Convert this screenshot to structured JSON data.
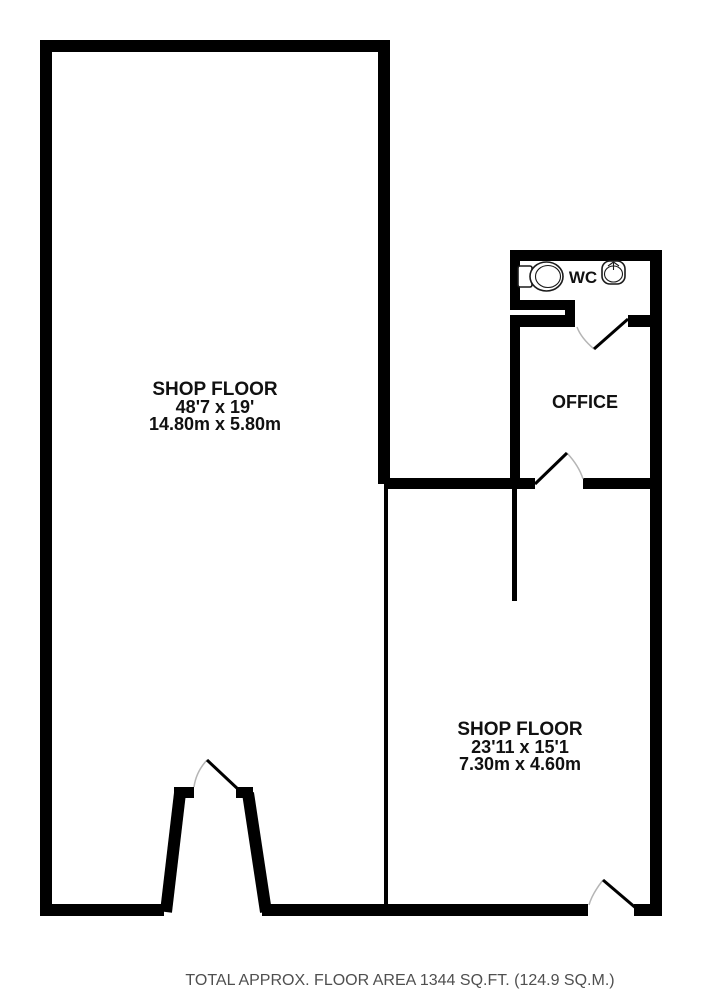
{
  "colors": {
    "wall": "#000000",
    "door_leaf": "#000000",
    "door_arc": "#b5b5b5",
    "fixture_outline": "#1a1a1a",
    "label": "#111111",
    "footer": "#4f4f4f",
    "background": "#ffffff"
  },
  "rooms": {
    "shop_floor_main": {
      "name": "SHOP FLOOR",
      "size_imperial": "48'7 x 19'",
      "size_metric": "14.80m x 5.80m"
    },
    "shop_floor_rear": {
      "name": "SHOP FLOOR",
      "size_imperial": "23'11 x 15'1",
      "size_metric": "7.30m x 4.60m"
    },
    "office": {
      "name": "OFFICE"
    },
    "wc": {
      "name": "WC"
    }
  },
  "fixtures": {
    "toilet": "toilet-icon",
    "sink": "sink-icon"
  },
  "footer": {
    "text": "TOTAL APPROX. FLOOR AREA 1344 SQ.FT. (124.9 SQ.M.)"
  }
}
